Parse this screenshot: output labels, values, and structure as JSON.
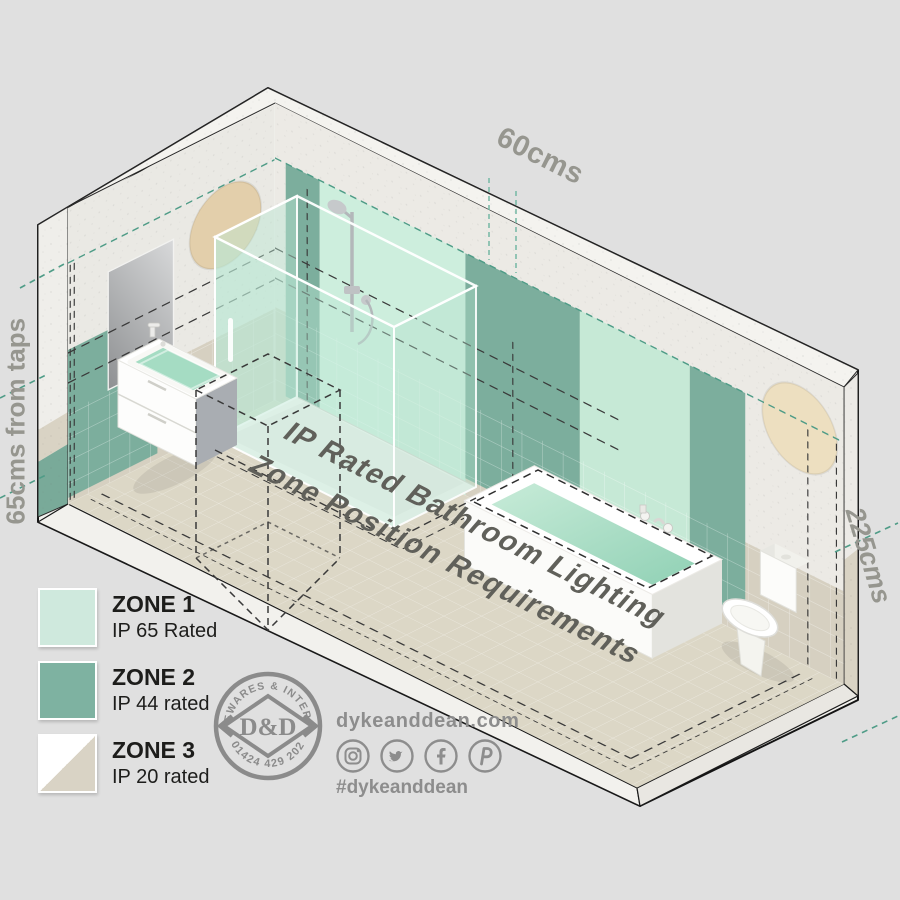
{
  "scene": {
    "dim_top": "60cms",
    "dim_left": "65cms from taps",
    "dim_right": "225cms",
    "floor_title_line1": "IP Rated Bathroom Lighting",
    "floor_title_line2": "Zone Position Requirements"
  },
  "legend": {
    "items": [
      {
        "label": "ZONE 1",
        "rating": "IP 65 Rated",
        "color": "#cfe9dd"
      },
      {
        "label": "ZONE 2",
        "rating": "IP 44 rated",
        "color": "#7eb2a1"
      },
      {
        "label": "ZONE 3",
        "rating": "IP 20 rated",
        "color": "#d9d3c5",
        "color2": "#ffffff"
      }
    ]
  },
  "logo": {
    "arc_top": "HOMEWARES & INTERIORS",
    "monogram": "D&D",
    "arc_bottom": "01424 429 202"
  },
  "social": {
    "website": "dykeanddean.com",
    "hashtag": "#dykeanddean",
    "icons": [
      "instagram-icon",
      "twitter-icon",
      "facebook-icon",
      "pinterest-icon"
    ]
  },
  "colors": {
    "background": "#e0e0e0",
    "zone1_mint": "#cfe9dd",
    "zone2_green": "#7eb2a1",
    "zone3_tile": "#d9d3c5",
    "teal_dash": "#4f9c87",
    "black_dash": "#3a3a3a",
    "dim_text": "#96968f"
  }
}
